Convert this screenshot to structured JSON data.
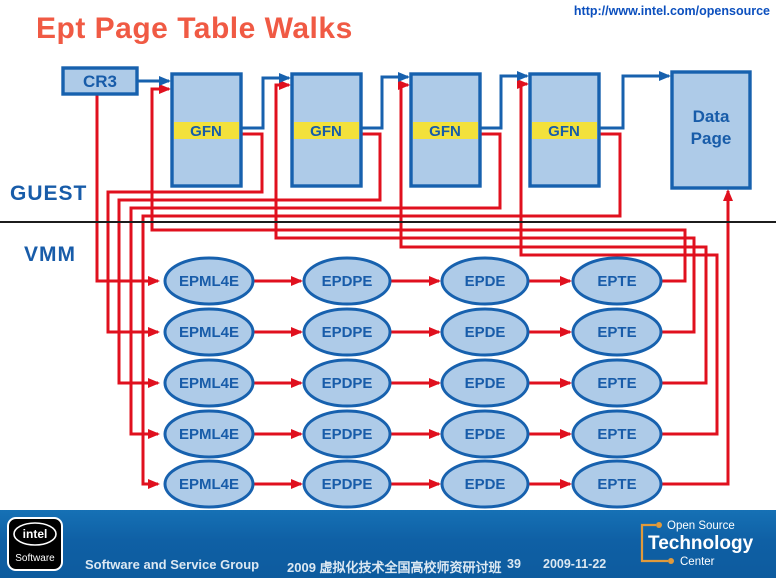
{
  "header": {
    "title": "Ept Page Table Walks",
    "url": "http://www.intel.com/opensource"
  },
  "diagram": {
    "cr3_label": "CR3",
    "gfn_label": "GFN",
    "data_page": [
      "Data",
      "Page"
    ],
    "guest_label": "GUEST",
    "vmm_label": "VMM",
    "columns": [
      "EPML4E",
      "EPDPE",
      "EPDE",
      "EPTE"
    ],
    "row_count": 5,
    "page_table_count": 4,
    "colors": {
      "title_red": "#f05a44",
      "node_fill": "#aecbe8",
      "node_stroke": "#1761ae",
      "gfn_yellow": "#f3e13b",
      "walk_red": "#e0101e",
      "guest_blue": "#1761ae",
      "footer_blue": "#0f60a5",
      "url_blue": "#0b4fbe"
    }
  },
  "footer": {
    "intel_badge": {
      "brand": "intel",
      "product": "Software"
    },
    "group_label": "Software and Service Group",
    "event_label": "2009 虚拟化技术全国高校师资研讨班",
    "page_number": "39",
    "date": "2009-11-22",
    "ostc": {
      "top": "Open Source",
      "middle": "Technology",
      "bottom": "Center"
    }
  }
}
